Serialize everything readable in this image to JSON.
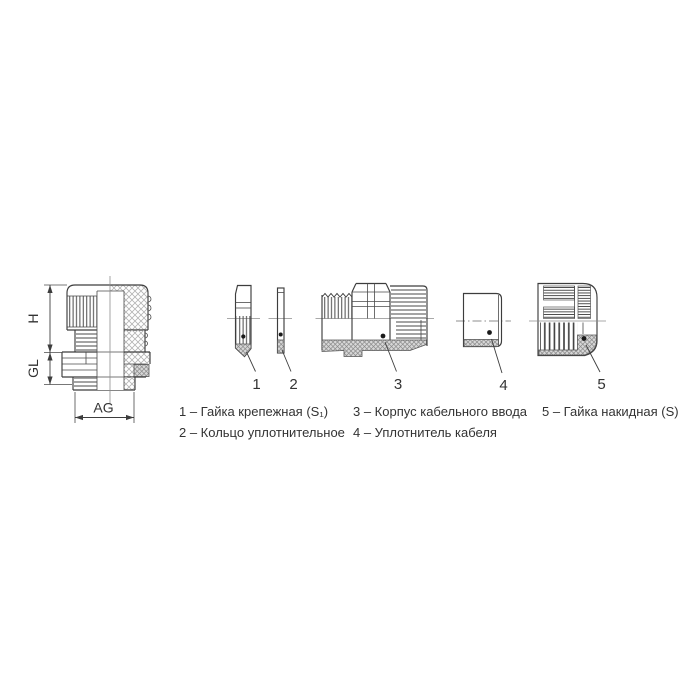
{
  "drawing": {
    "assembled": {
      "dim_h": "H",
      "dim_gl": "GL",
      "dim_ag": "AG"
    },
    "parts": [
      {
        "num": "1",
        "legend": "1 – Гайка крепежная (S₁)"
      },
      {
        "num": "2",
        "legend": "2 – Кольцо уплотнительное"
      },
      {
        "num": "3",
        "legend": "3 – Корпус кабельного ввода"
      },
      {
        "num": "4",
        "legend": "4 – Уплотнитель кабеля"
      },
      {
        "num": "5",
        "legend": "5 – Гайка накидная (S)"
      }
    ],
    "colors": {
      "line": "#3d3d3d",
      "centerline": "#8d8d8d",
      "section_hatch": "#b3b3b3",
      "rubber_fill": "#d7d7d7",
      "rubber_hatch": "#8a8a8a",
      "background": "#ffffff"
    }
  }
}
